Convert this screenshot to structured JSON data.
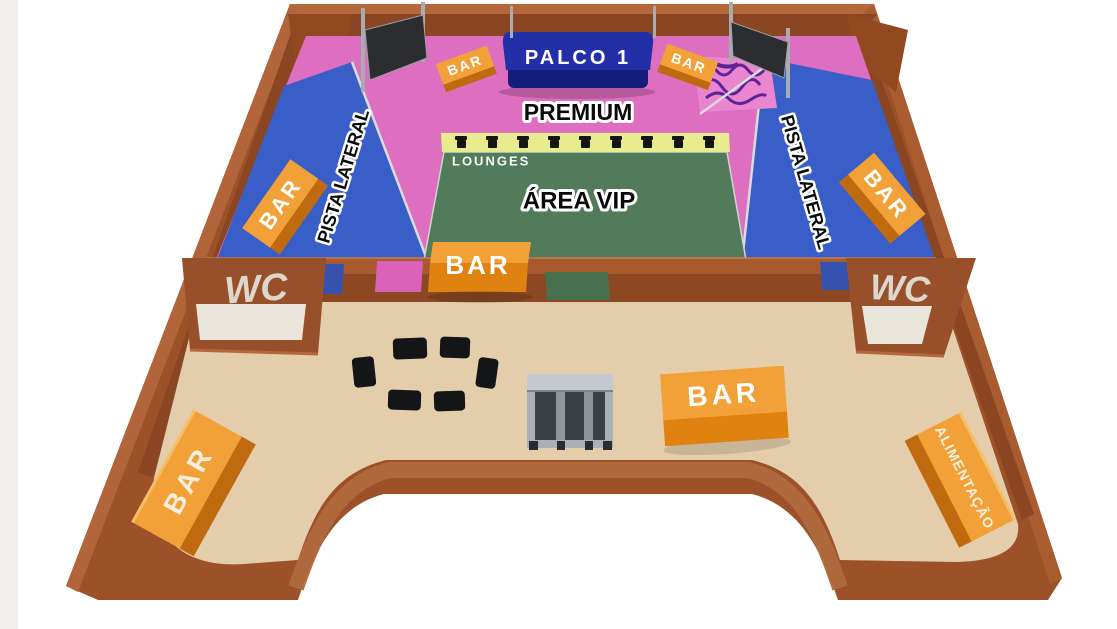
{
  "labels": {
    "stage": "PALCO 1",
    "premium": "PREMIUM",
    "vip": "ÁREA VIP",
    "lounges": "LOUNGES",
    "pista_left": "PISTA LATERAL",
    "pista_right": "PISTA LATERAL",
    "wc_left": "WC",
    "wc_right": "WC",
    "food": "ALIMENTAÇÃO",
    "bar_stage_left": "BAR",
    "bar_stage_right": "BAR",
    "bar_pista_left": "BAR",
    "bar_pista_right": "BAR",
    "bar_vip_wall": "BAR",
    "bar_lower_center": "BAR",
    "bar_lower_left": "BAR"
  },
  "colors": {
    "background": "#ffffff",
    "left_margin": "#f1efec",
    "wall_top": "#b4673a",
    "wall_base": "#9c5128",
    "wall_inner": "#8a4523",
    "divider_top": "#a85a2e",
    "divider_front": "#8c4822",
    "premium_pink": "#de6ec0",
    "pista_blue": "#3a5ec8",
    "vip_green": "#517b5a",
    "lounge_yellow": "#e9ec8e",
    "floor_beige": "#e4cdab",
    "room_floor": "#eae5da",
    "bar_orange_top": "#f2a139",
    "bar_orange_front": "#e0820f",
    "bar_orange_side": "#c06a10",
    "stage_navy_top": "#232fa6",
    "stage_navy_front": "#141d7e",
    "screen_dark": "#2c2d30",
    "pole_gray": "#a7acb0",
    "gate_frame": "#c3c9cc",
    "gate_inner": "#3b4045",
    "furniture_black": "#141517",
    "label_black": "#0a0a0a",
    "label_white": "#ffffff",
    "wc_text": "#ddd7cd",
    "rail_gray": "#d9dbdd",
    "scribble_purple": "#45138f"
  }
}
